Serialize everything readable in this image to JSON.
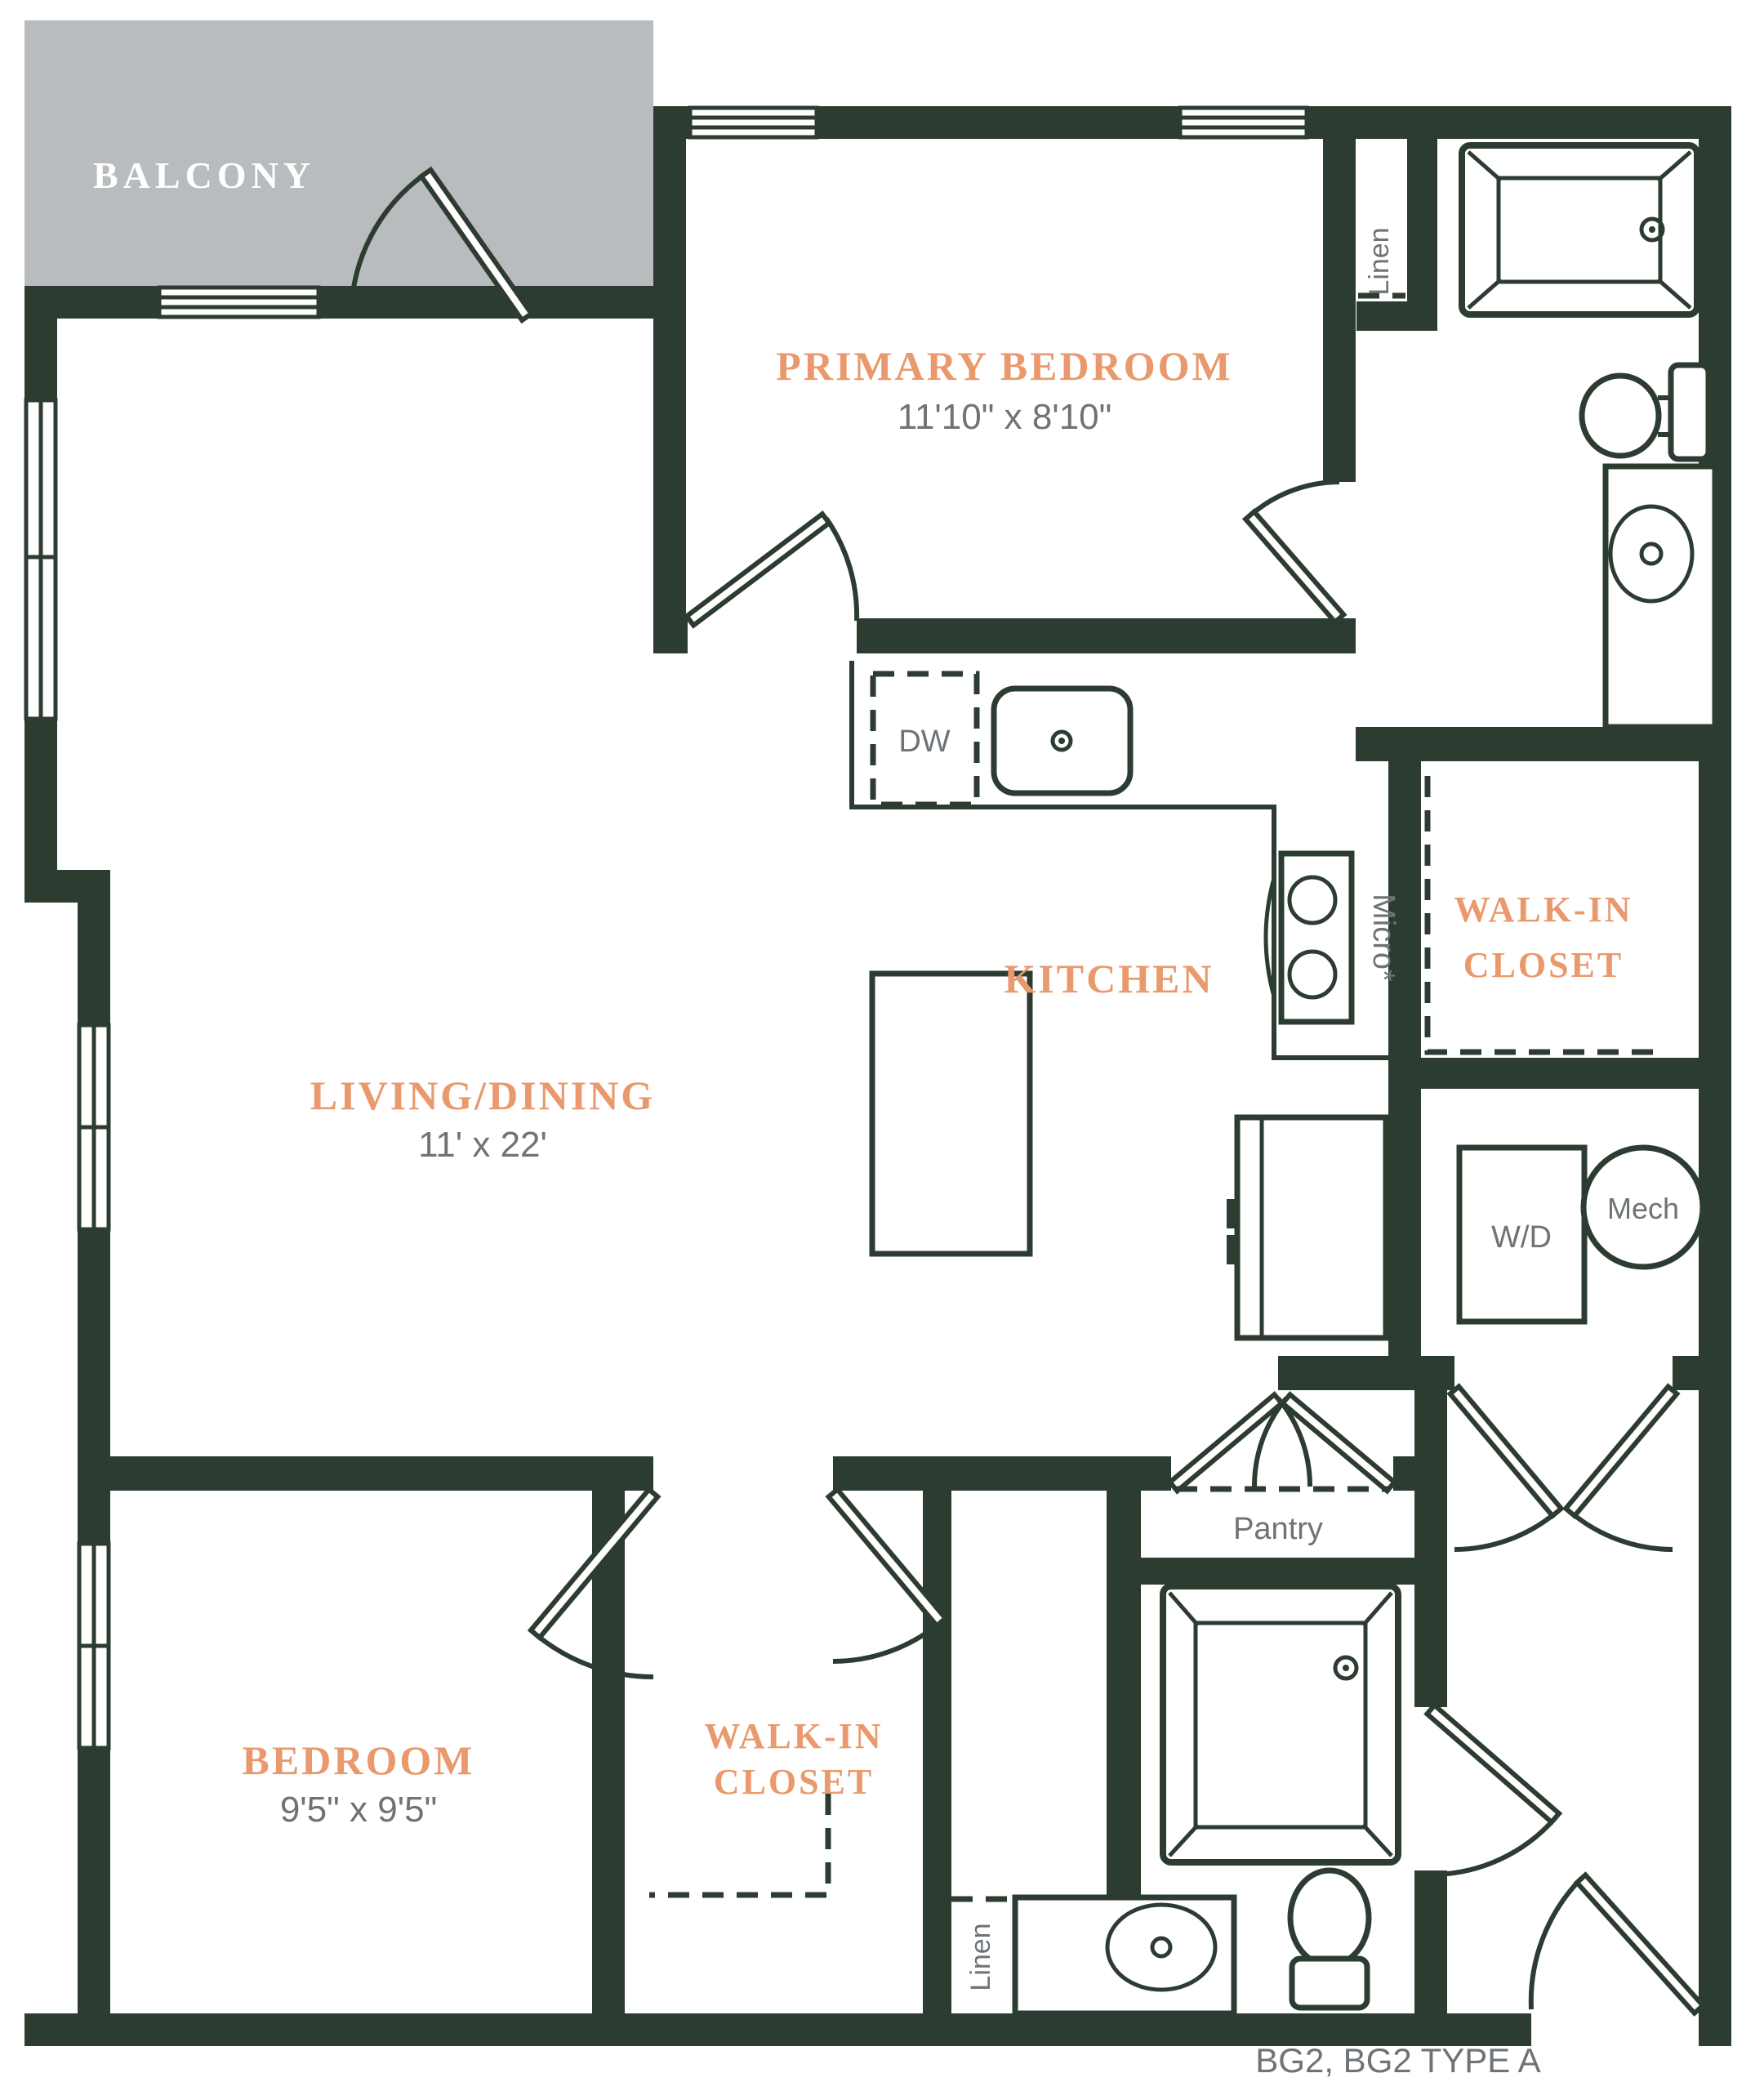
{
  "title": "BG2, BG2 TYPE A",
  "colors": {
    "wall": "#2d3c31",
    "balcony": "#b9bcbe",
    "accent": "#e9996c",
    "dim_text": "#6e7377",
    "background": "#ffffff"
  },
  "rooms": {
    "balcony": {
      "label": "BALCONY"
    },
    "primary_bedroom": {
      "label": "PRIMARY BEDROOM",
      "dims": "11'10\" x 8'10\""
    },
    "kitchen": {
      "label": "KITCHEN"
    },
    "primary_walk_in_closet": {
      "line1": "WALK-IN",
      "line2": "CLOSET"
    },
    "living_dining": {
      "label": "LIVING/DINING",
      "dims": "11' x 22'"
    },
    "bedroom": {
      "label": "BEDROOM",
      "dims": "9'5\" x 9'5\""
    },
    "bedroom_walk_in_closet": {
      "line1": "WALK-IN",
      "line2": "CLOSET"
    },
    "pantry": {
      "label": "Pantry"
    }
  },
  "fixtures": {
    "dishwasher": "DW",
    "microwave": "Micro*",
    "washer_dryer": "W/D",
    "mechanical": "Mech",
    "linen_primary": "Linen",
    "linen_bath2": "Linen"
  }
}
